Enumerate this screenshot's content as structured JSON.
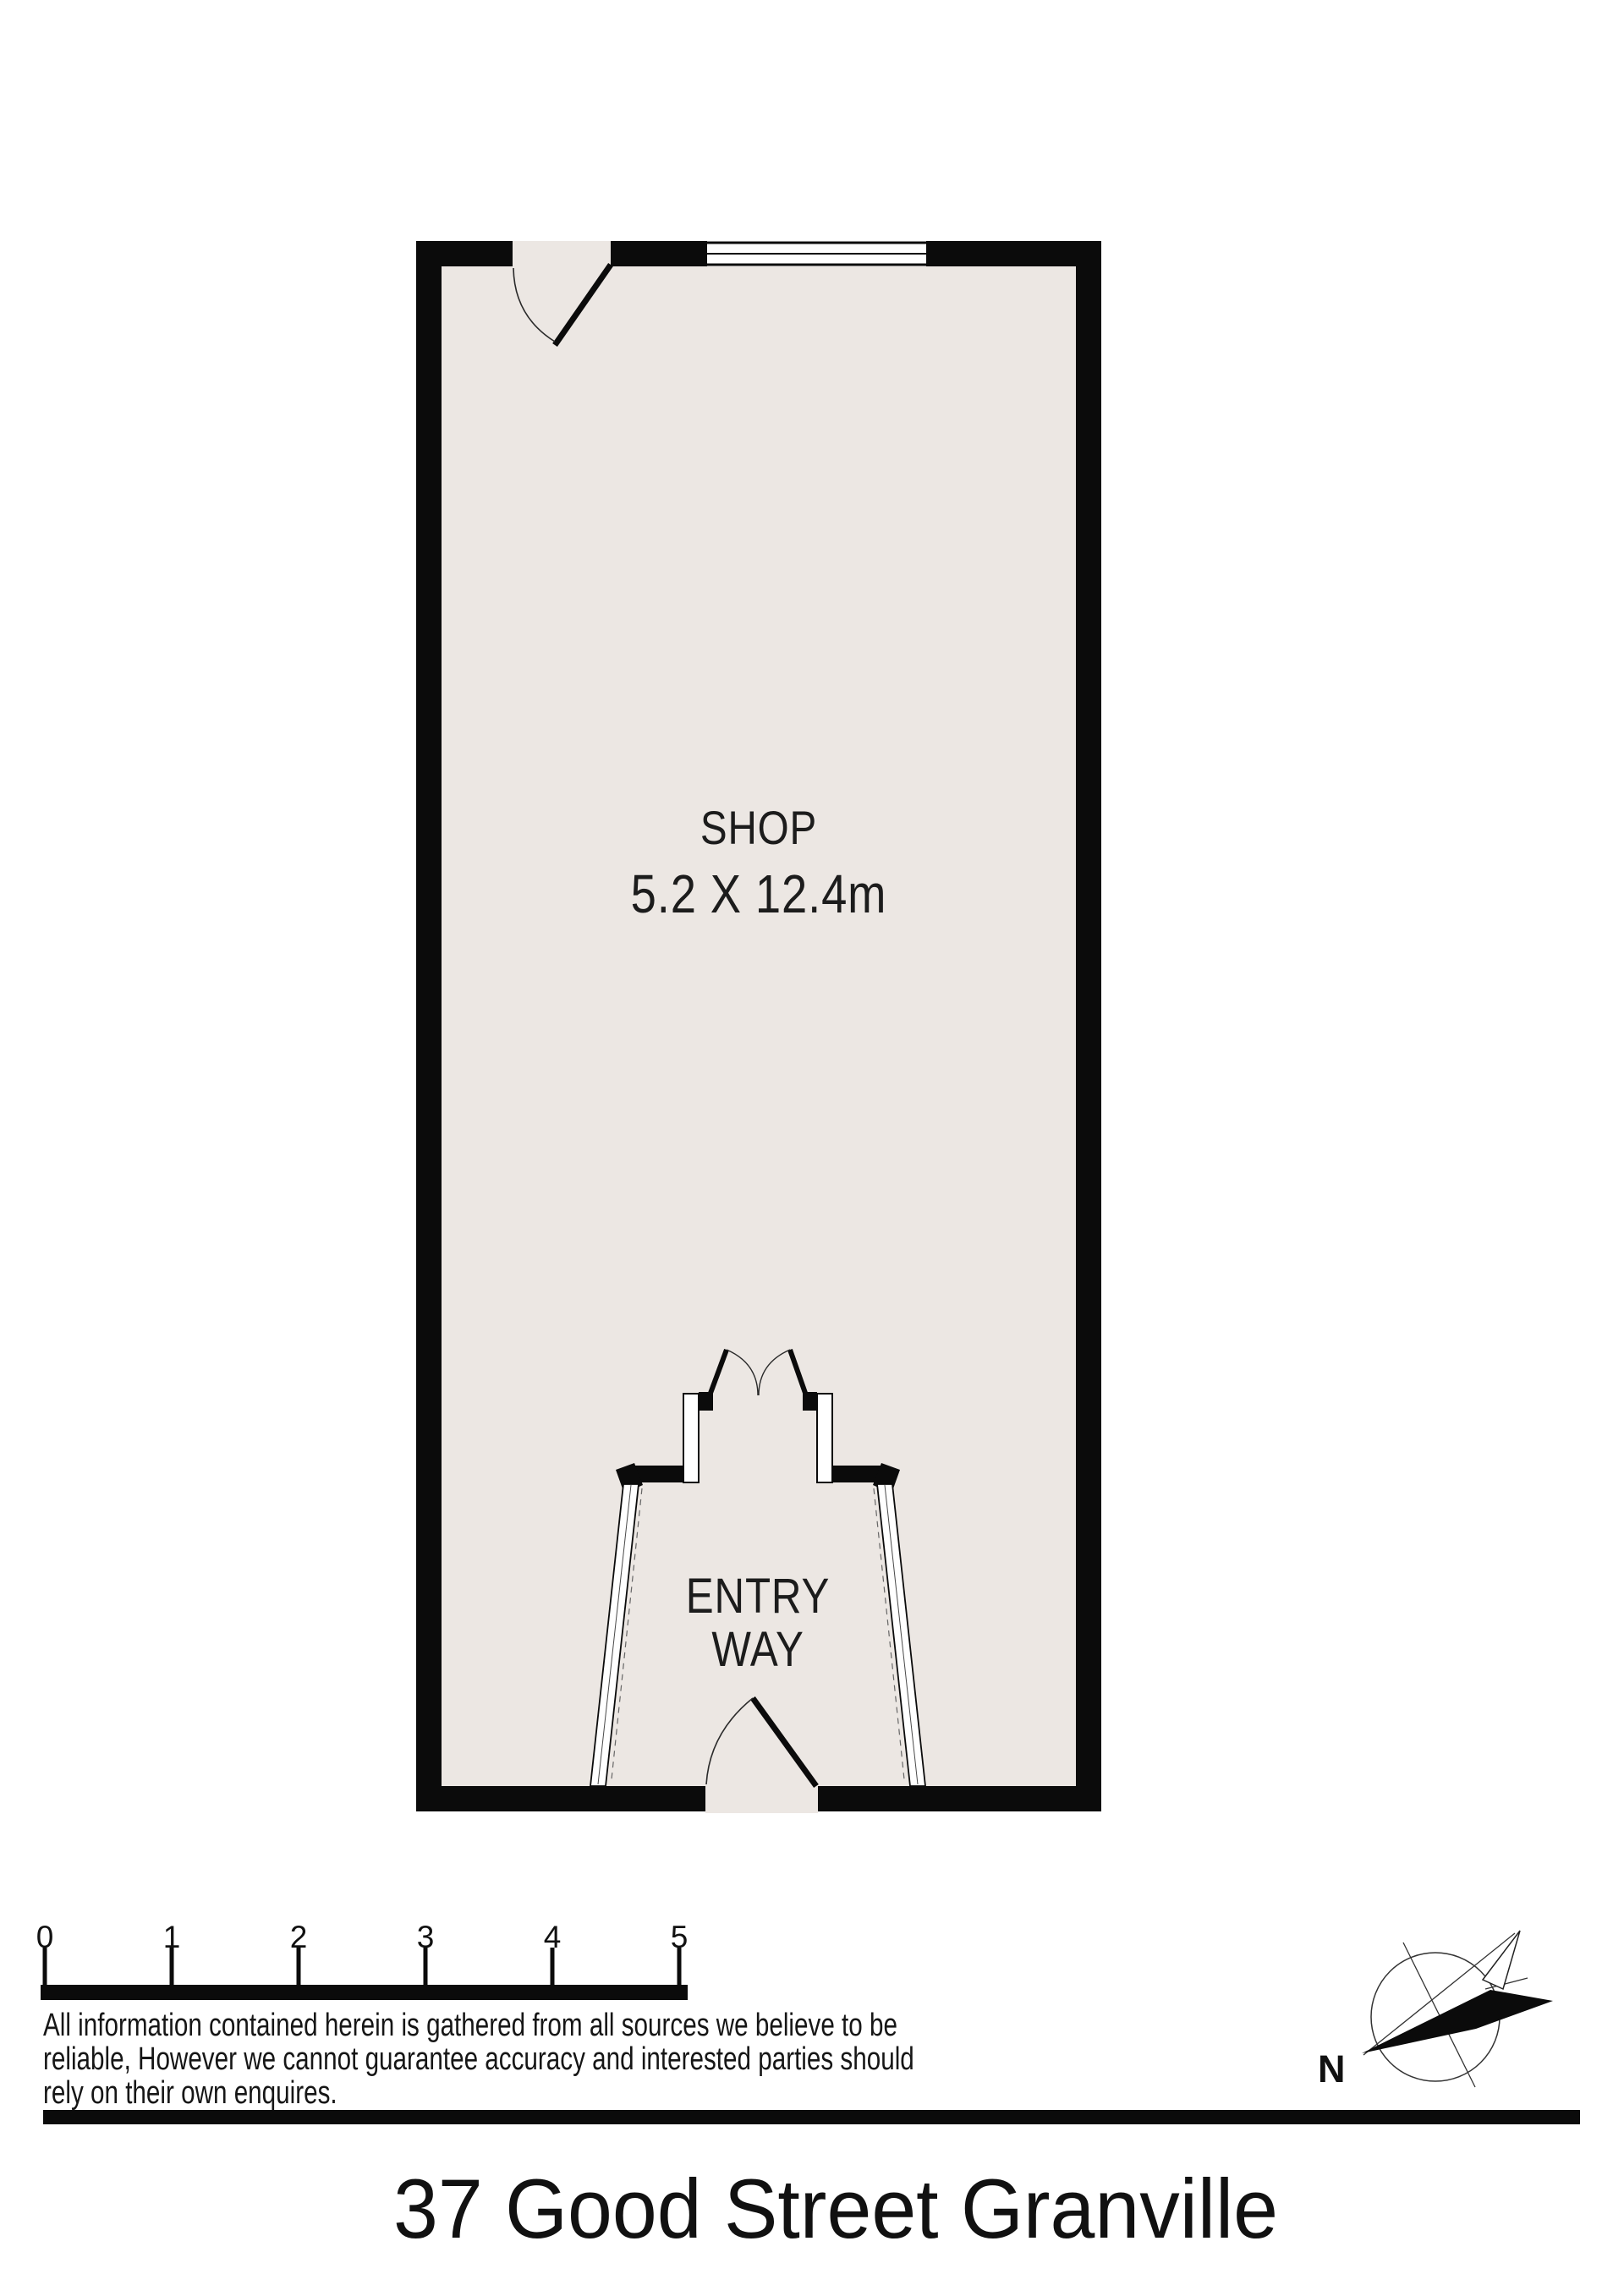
{
  "floor_plan": {
    "floor_color": "#ECE7E3",
    "wall_color": "#0B0B0B",
    "room": {
      "label": "SHOP",
      "dimensions": "5.2 X 12.4m"
    },
    "entry": {
      "label_line1": "ENTRY",
      "label_line2": "WAY"
    }
  },
  "scale_bar": {
    "tick_labels": [
      "0",
      "1",
      "2",
      "3",
      "4",
      "5"
    ]
  },
  "disclaimer": {
    "lines": [
      "All information contained herein is gathered from all sources we believe to be",
      "reliable, However we cannot guarantee accuracy and interested parties should",
      "rely on their own enquires."
    ]
  },
  "compass": {
    "north_label": "N"
  },
  "footer": {
    "title": "37 Good Street Granville"
  }
}
